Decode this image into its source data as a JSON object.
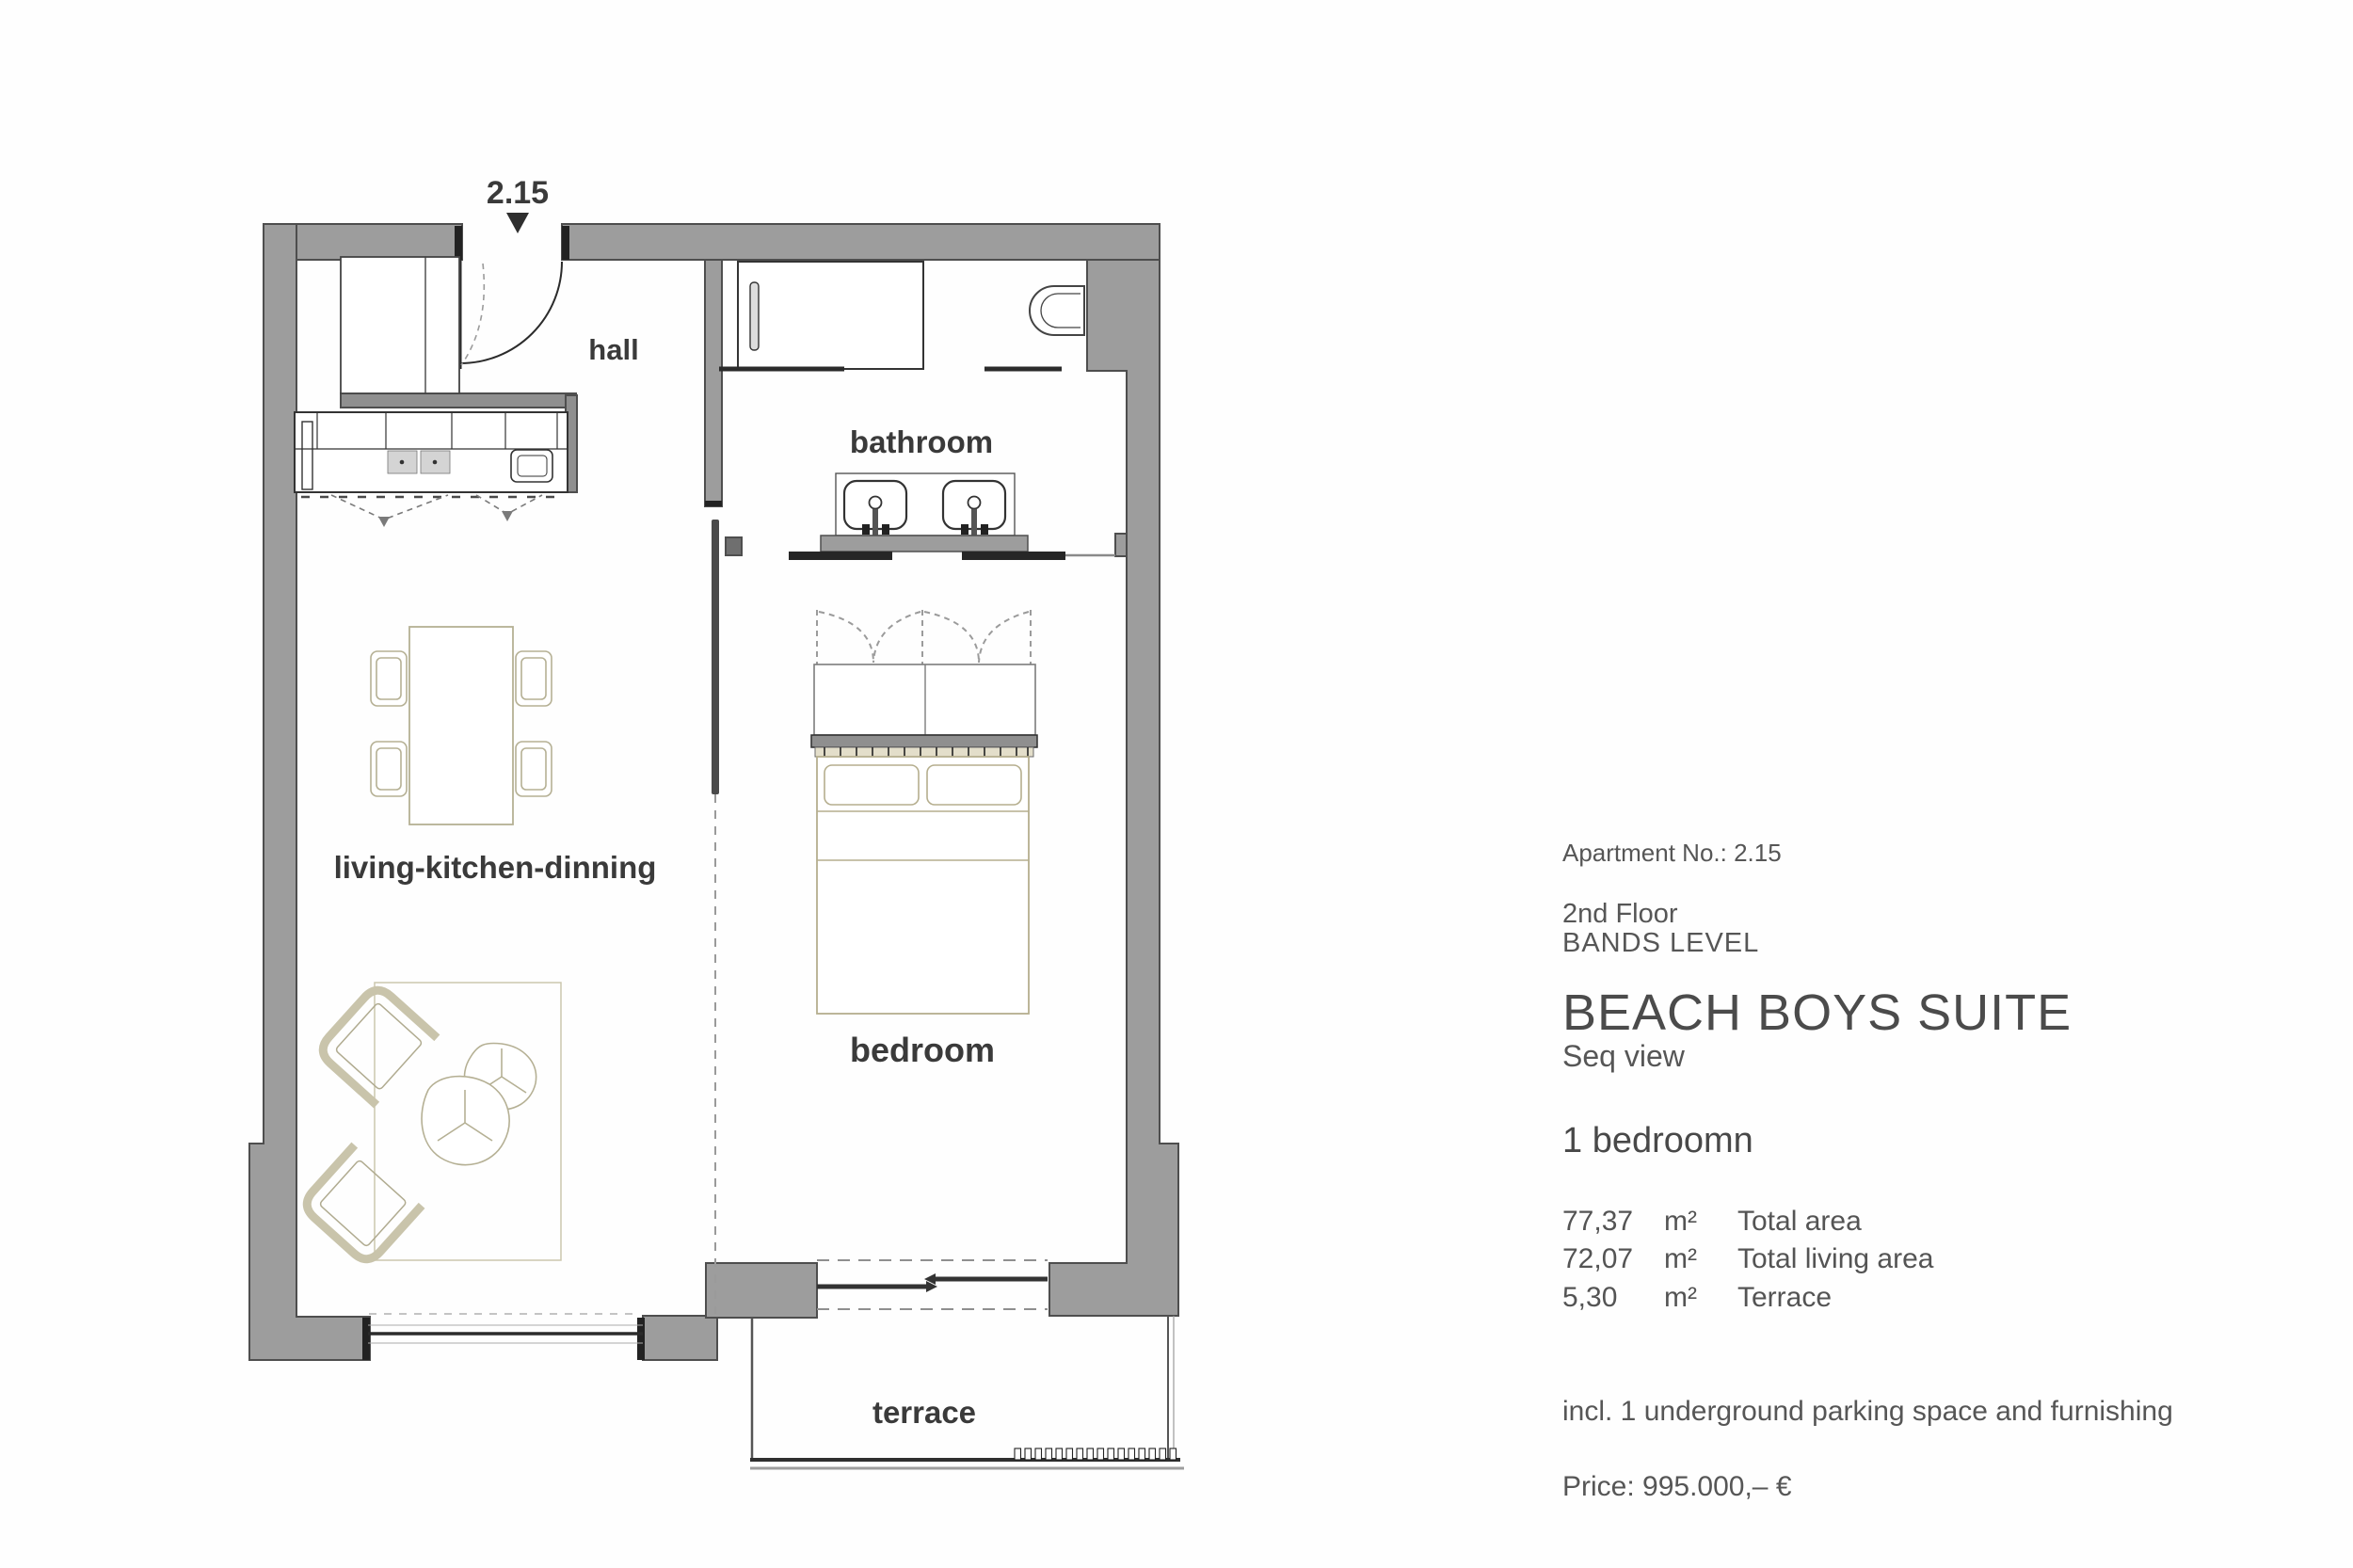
{
  "plan": {
    "unit_number": "2.15",
    "labels": {
      "hall": "hall",
      "bathroom": "bathroom",
      "living": "living-kitchen-dinning",
      "bedroom": "bedroom",
      "terrace": "terrace"
    }
  },
  "panel": {
    "apartment_no": "Apartment No.: 2.15",
    "floor": "2nd Floor",
    "level": "BANDS LEVEL",
    "suite_name": "BEACH BOYS SUITE",
    "view": "Seq view",
    "bedrooms": "1 bedroomn",
    "areas": [
      {
        "value": "77,37",
        "unit": "m²",
        "label": "Total area"
      },
      {
        "value": "72,07",
        "unit": "m²",
        "label": "Total living area"
      },
      {
        "value": "5,30",
        "unit": "m²",
        "label": "Terrace"
      }
    ],
    "includes": "incl. 1 underground parking space and furnishing",
    "price": "Price: 995.000,– €"
  },
  "colors": {
    "wall_fill": "#9d9d9d",
    "wall_stroke": "#4e4e4e",
    "detail_line": "#2b2b2b",
    "furniture_tan": "#b5b094",
    "dashed_gray": "#9b9b9b",
    "text_gray": "#565656"
  }
}
